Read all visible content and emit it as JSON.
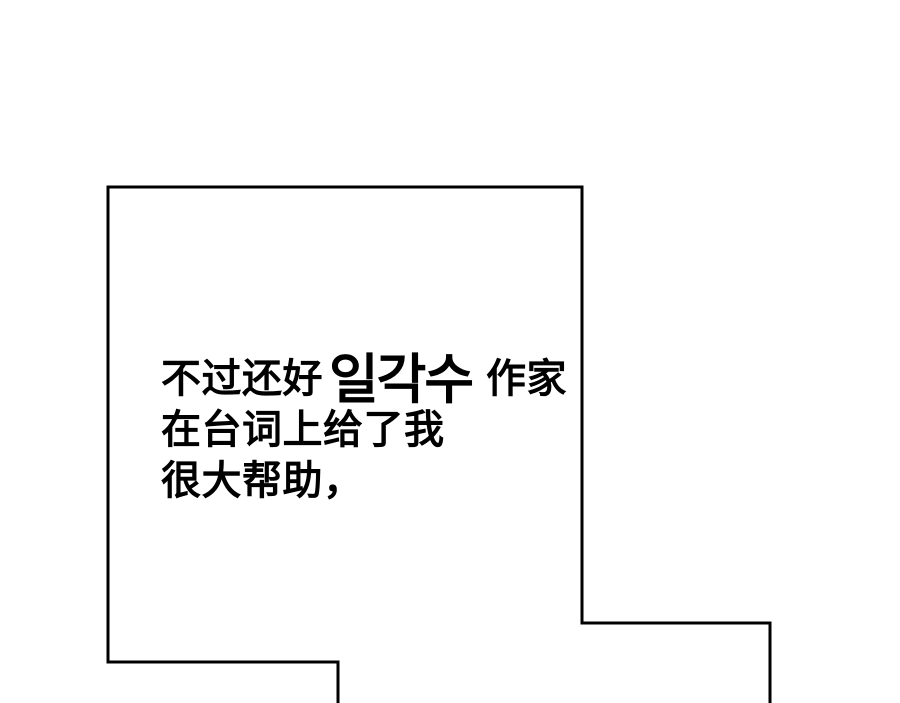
{
  "panel": {
    "colors": {
      "background": "#ffffff",
      "border": "#000000",
      "text": "#000000"
    },
    "dialogue": {
      "line1": {
        "chinese_prefix": "不过还好",
        "korean_name": "일각수",
        "chinese_suffix": "作家"
      },
      "line2": "在台词上给了我",
      "line3": "很大帮助，"
    }
  }
}
